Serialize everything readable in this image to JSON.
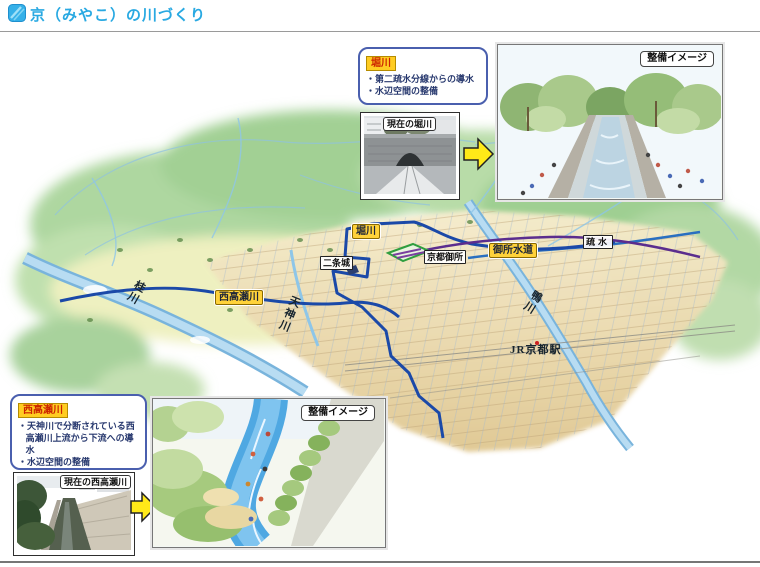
{
  "header": {
    "title": "京（みやこ）の川づくり",
    "accent_color": "#29a9e2",
    "icon": "brush-square-icon"
  },
  "map": {
    "labels": {
      "horikawa": "堀川",
      "nijo_castle": "二条城",
      "kyoto_gosho": "京都御所",
      "gosho_suido": "御所水道",
      "sosui": "疏水",
      "nishitakase": "西高瀬川",
      "katsura_river": "桂川",
      "tenjin_river": "天神川",
      "kamo_river": "鴨川",
      "jr_kyoto_station": "JR京都駅"
    },
    "colors": {
      "route_blue": "#1b49a8",
      "river_blue": "#79b4dc",
      "waterway_purple": "#5b2d8e",
      "label_yellow": "#ffd23a",
      "mountain_green": "#a9d29a",
      "city_tan": "#ecd9a8"
    }
  },
  "callout_horikawa": {
    "title": "堀川",
    "bullets": [
      "・第二疏水分線からの導水",
      "・水辺空間の整備"
    ],
    "photo_label": "現在の堀川",
    "image_label": "整備イメージ"
  },
  "callout_nishitakase": {
    "title": "西高瀬川",
    "bullets": [
      "・天神川で分断されている西高瀬川上流から下流への導水",
      "・水辺空間の整備"
    ],
    "photo_label": "現在の西高瀬川",
    "image_label": "整備イメージ"
  }
}
